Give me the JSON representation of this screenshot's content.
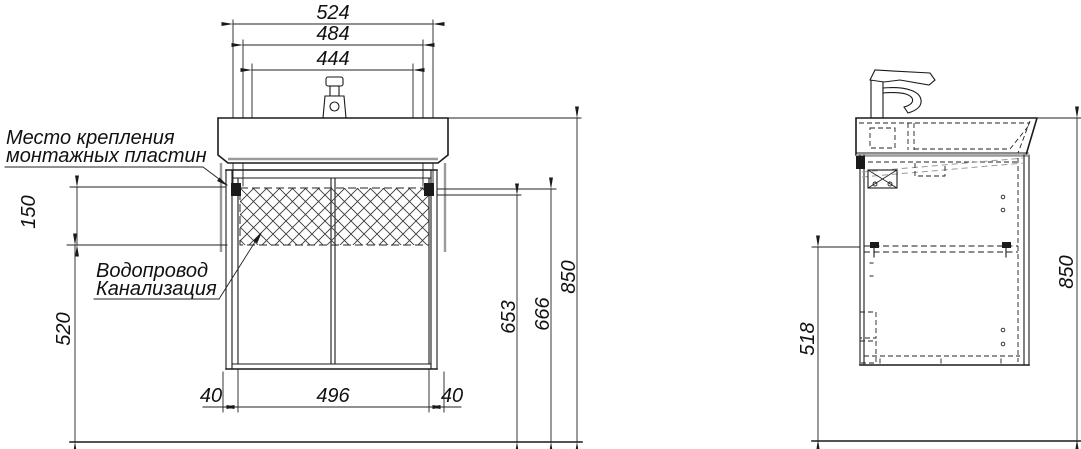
{
  "colors": {
    "line": "#1a1a1a",
    "accent_gray": "#9a9a9a",
    "background": "#ffffff"
  },
  "front": {
    "dim_top_outer": "524",
    "dim_top_mid": "484",
    "dim_top_inner": "444",
    "dim_hatch_height": "150",
    "dim_lower_height": "520",
    "dim_bottom_left": "40",
    "dim_bottom_center": "496",
    "dim_bottom_right": "40",
    "dim_right_inner": "653",
    "dim_right_mid": "666",
    "dim_right_outer": "850",
    "label_mounting_line1": "Место крепления",
    "label_mounting_line2": "монтажных пластин",
    "label_plumbing_line1": "Водопровод",
    "label_plumbing_line2": "Канализация"
  },
  "side": {
    "dim_left": "518",
    "dim_right": "850"
  }
}
